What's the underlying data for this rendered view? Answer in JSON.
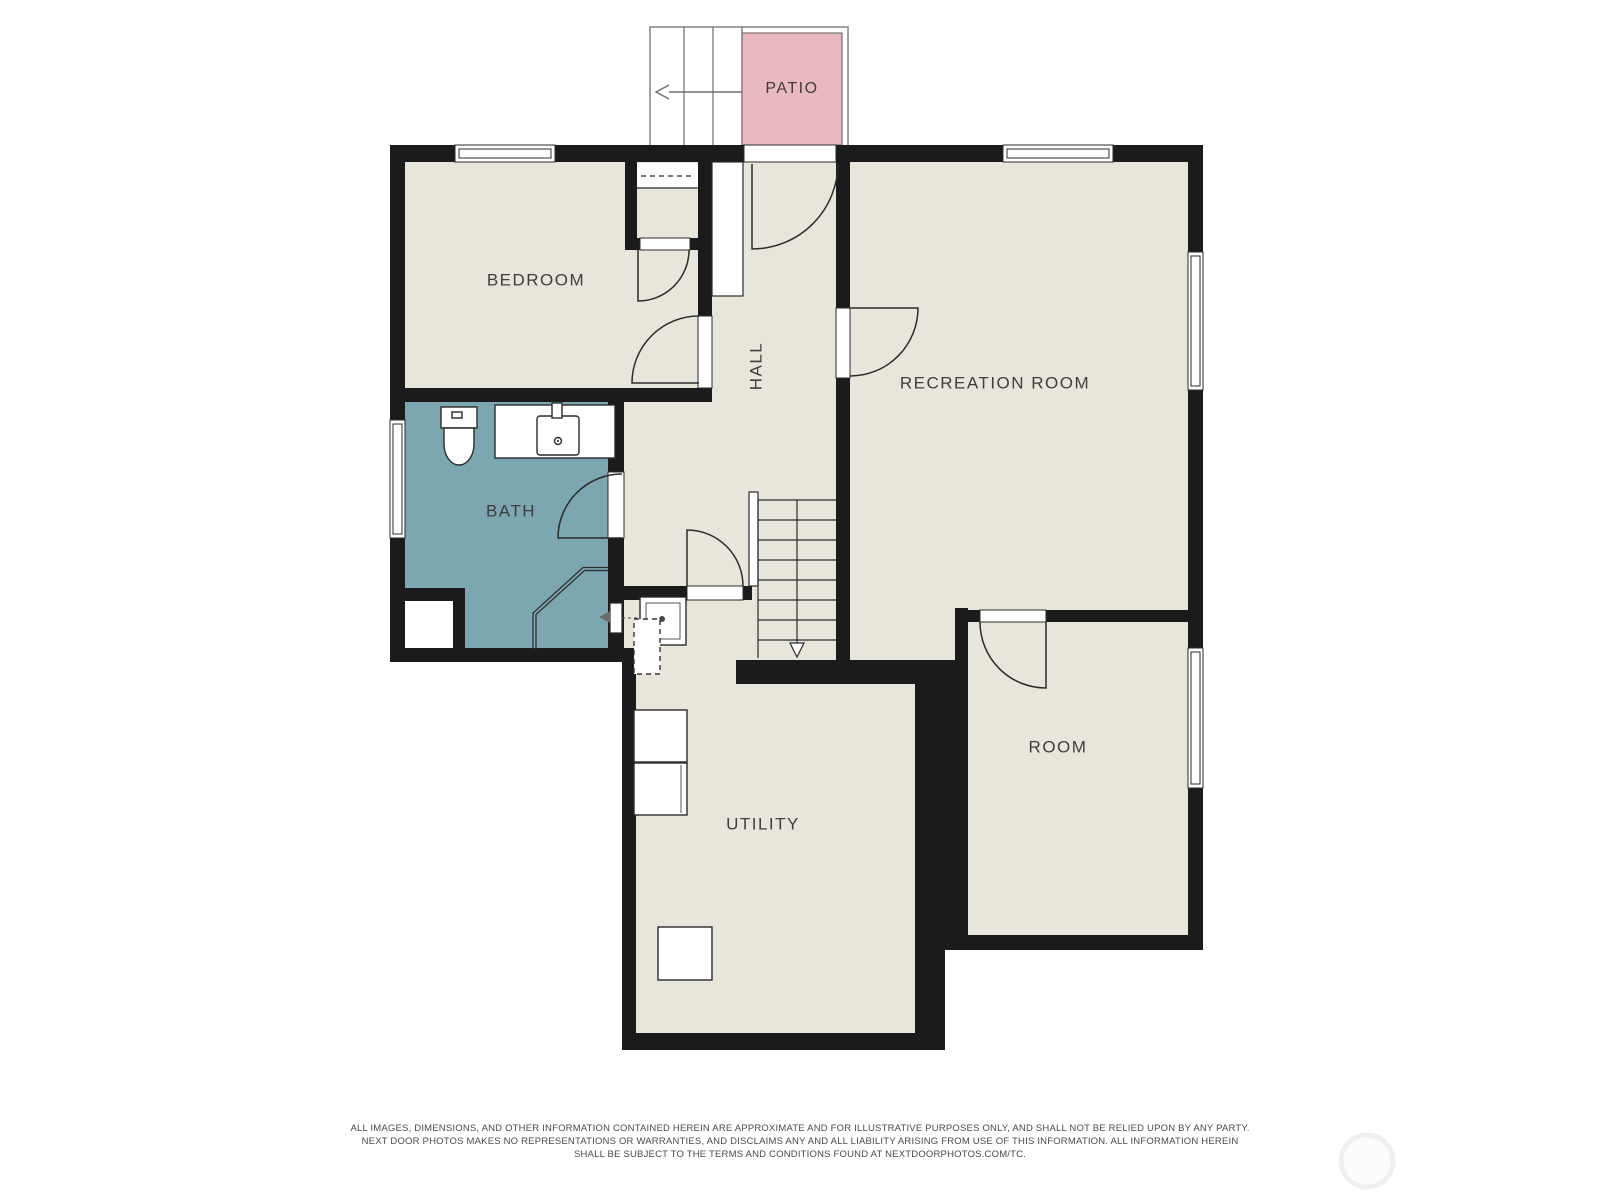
{
  "floorplan": {
    "labels": {
      "patio": "PATIO",
      "bedroom": "BEDROOM",
      "hall": "HALL",
      "recreation_room": "RECREATION ROOM",
      "bath": "BATH",
      "utility": "UTILITY",
      "room": "ROOM"
    },
    "colors": {
      "wall": "#1b1b1b",
      "room_fill": "#e8e6da",
      "bath_fill": "#7ca6b0",
      "patio_fill": "#eab8bf",
      "line": "#2b2b2b",
      "label": "#3e3e3e",
      "stair_outline": "#828282"
    }
  },
  "disclaimer": {
    "line1": "ALL IMAGES, DIMENSIONS, AND OTHER INFORMATION CONTAINED HEREIN ARE APPROXIMATE AND FOR ILLUSTRATIVE PURPOSES ONLY, AND SHALL NOT BE RELIED UPON BY ANY PARTY.",
    "line2": "NEXT DOOR PHOTOS MAKES NO REPRESENTATIONS OR WARRANTIES, AND DISCLAIMS ANY AND ALL LIABILITY ARISING FROM USE OF THIS INFORMATION. ALL INFORMATION HEREIN",
    "line3": "SHALL BE SUBJECT TO THE TERMS AND CONDITIONS FOUND AT NEXTDOORPHOTOS.COM/TC."
  }
}
